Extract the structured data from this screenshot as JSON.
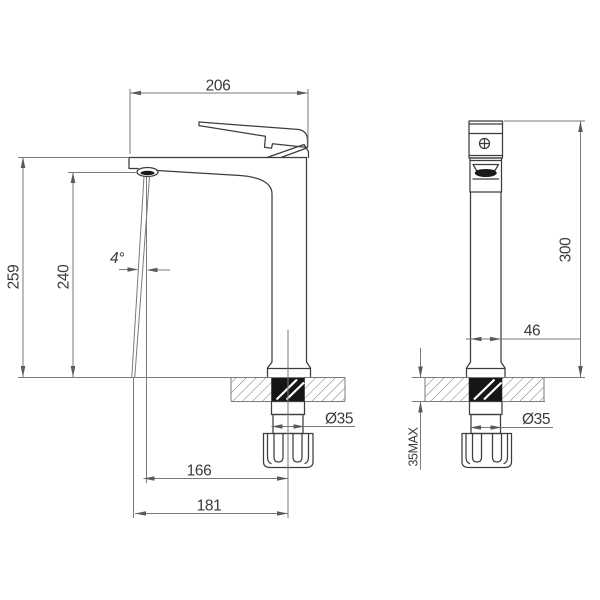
{
  "meta": {
    "type": "technical-drawing",
    "subject": "Tall basin mixer tap, dimensioned front and side views",
    "units": "mm"
  },
  "front_view": {
    "dim_spout_width": "206",
    "dim_total_height": "259",
    "dim_spout_height": "240",
    "dim_stream_angle": "4°",
    "dim_reach_aerator": "166",
    "dim_reach_overall": "181",
    "dim_shank_diameter": "Ø35"
  },
  "side_view": {
    "dim_height": "300",
    "dim_body_width": "46",
    "dim_shank_diameter": "Ø35",
    "dim_max_counter_thickness": "35MAX"
  },
  "colors": {
    "background": "#ffffff",
    "object_line": "#3d3d3d",
    "dimension_line": "#7a7a7a",
    "shank_fill": "#161616"
  }
}
